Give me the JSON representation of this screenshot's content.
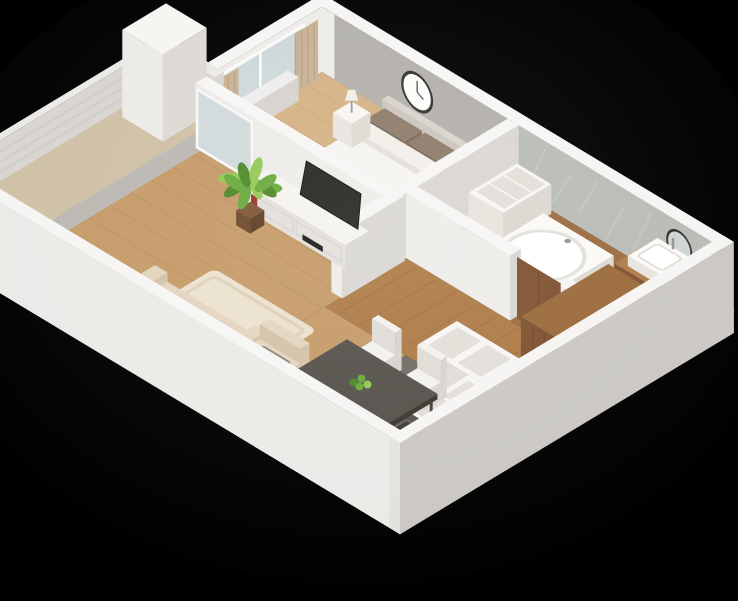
{
  "scene": {
    "type": "isometric-3d-apartment-floorplan-render",
    "background": "#000000",
    "rooms": [
      {
        "name": "bedroom",
        "furniture": [
          "double-bed",
          "brown-pillows",
          "white-pillows",
          "headboard",
          "nightstand-left",
          "nightstand-right",
          "table-lamp-left",
          "table-lamp-right",
          "wall-clock",
          "gray-accent-wall",
          "window-with-curtains",
          "radiator"
        ]
      },
      {
        "name": "bathroom",
        "furniture": [
          "bathtub",
          "vanity-with-sink",
          "round-mirror",
          "toilet",
          "open-shelf-unit",
          "marble-wall",
          "wood-door"
        ]
      },
      {
        "name": "living-room",
        "furniture": [
          "sofa",
          "chaise-armchair",
          "area-rug",
          "tv-stand",
          "tv",
          "monstera-plant",
          "curtains",
          "balcony-glass-doors"
        ]
      },
      {
        "name": "dining-area",
        "furniture": [
          "dark-dining-table",
          "white-chairs",
          "green-centerpiece"
        ]
      },
      {
        "name": "kitchen",
        "furniture": [
          "white-l-counter",
          "dark-countertop-with-sink",
          "black-floor-mat",
          "dark-tile-floor"
        ]
      },
      {
        "name": "hallway",
        "furniture": [
          "wood-wardrobe",
          "wood-floor"
        ]
      },
      {
        "name": "balcony",
        "furniture": [
          "white-railing",
          "tall-white-cabinet",
          "balcony-slab"
        ]
      }
    ]
  },
  "colors": {
    "bg": "#000000",
    "wallTop": "#f6f5f3",
    "wallFace": "#eeece9",
    "wallShade": "#d9d6d2",
    "wallOuter": "#e9e7e4",
    "wallOuterDark": "#cbc8c4",
    "floorLiving": "#c59a67",
    "floorBed": "#d4b183",
    "floorBath": "#9d6b3e",
    "floorHall": "#ad7a46",
    "floorKitchen": "#716b64",
    "accent": "#b3b0ab",
    "marble": "#b9bcb6",
    "marbleLight": "#c9ccc6",
    "curtain": "#c7b194",
    "curtainDark": "#ab9579",
    "glass": "#cdd7da",
    "frame": "#fafaf9",
    "bedWhite": "#f5f3ef",
    "bedShade": "#e6e2db",
    "headboard": "#d8d3cc",
    "pillowBrown": "#8d7a68",
    "pillowBrownDark": "#7a6958",
    "pillowWhite": "#f2efe9",
    "rug": "#ebe1cd",
    "rugShade": "#ddd2ba",
    "sofa": "#e3d5bf",
    "sofaShade": "#d2c2a8",
    "grayCushion": "#8b8680",
    "tableDark": "#55504a",
    "tableSide": "#433f3a",
    "chair": "#f3f1ee",
    "chairShade": "#dfdcd6",
    "tv": "#25231f",
    "stand": "#f5f3f0",
    "red": "#9e3028",
    "plant": "#68a83b",
    "plantDark": "#4b8827",
    "plantLight": "#92c853",
    "pot": "#7c5434",
    "wood": "#9b6b3b",
    "woodDark": "#7f5230",
    "counterDark": "#57524c",
    "black": "#191816",
    "porcelain": "#faf9f6",
    "porcelainShade": "#e8e5df",
    "mirror": "#ced5d3",
    "rim": "#33312e",
    "lamp": "#f1eee7",
    "metal": "#999691",
    "railing": "#ebe9e5",
    "railingShade": "#d8d5d0",
    "balconyFloor": "#cec0a5",
    "inset": "#e2dfd9",
    "white": "#f7f5f2"
  }
}
